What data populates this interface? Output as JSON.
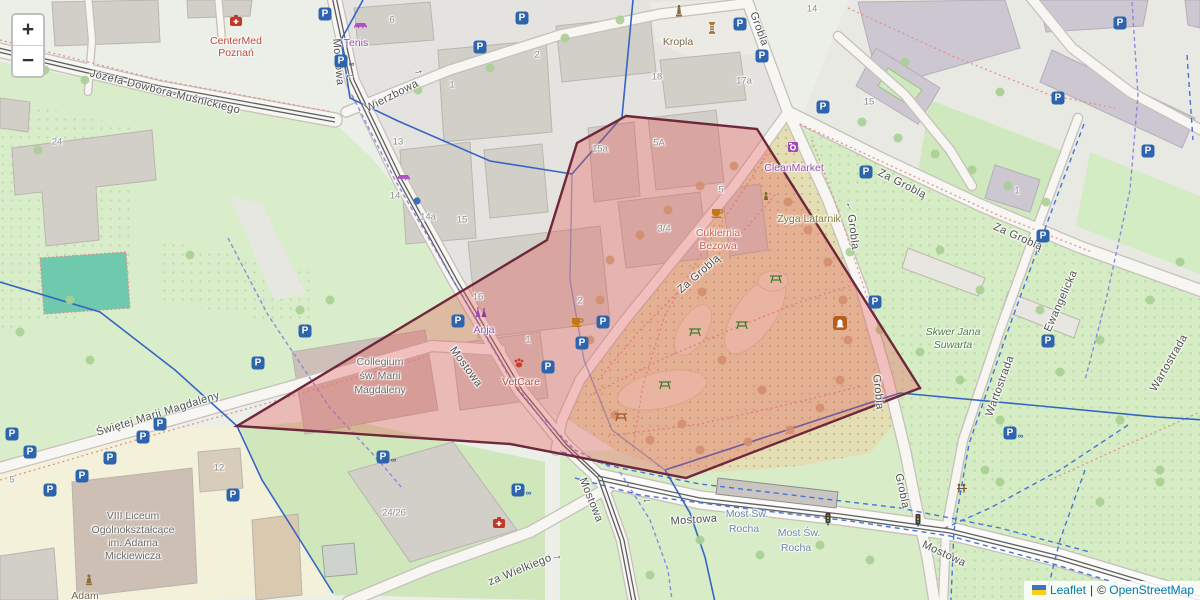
{
  "controls": {
    "zoom_in": "+",
    "zoom_out": "−"
  },
  "attribution": {
    "leaflet": "Leaflet",
    "separator": "|",
    "copyright_symbol": "©",
    "osm": "OpenStreetMap"
  },
  "colors": {
    "selection_fill": "rgba(232,82,82,0.33)",
    "selection_stroke": "#6e283c",
    "parking_blue": "#2d64ad",
    "leaflet_link": "#0078a8"
  },
  "selection": {
    "points": "626,116 757,129 920,388 686,478 510,444 237,426 497,270 547,240 577,143"
  },
  "map": {
    "labels": [
      {
        "t": "Józefa Dowbora-Muśnickiego",
        "x": 165,
        "y": 92,
        "r": 14,
        "c": "st"
      },
      {
        "t": "Mostowa",
        "x": 338,
        "y": 62,
        "r": 85,
        "c": "st"
      },
      {
        "t": "Mostowa",
        "x": 466,
        "y": 367,
        "r": 54,
        "c": "st"
      },
      {
        "t": "Mostowa",
        "x": 591,
        "y": 500,
        "r": 68,
        "c": "st"
      },
      {
        "t": "Mostowa",
        "x": 694,
        "y": 520,
        "r": -4,
        "c": "st"
      },
      {
        "t": "Mostowa",
        "x": 944,
        "y": 554,
        "r": 25,
        "c": "st"
      },
      {
        "t": "Wierzbowa",
        "x": 392,
        "y": 96,
        "r": -27,
        "c": "st"
      },
      {
        "t": "Grobla",
        "x": 759,
        "y": 29,
        "r": 70,
        "c": "st"
      },
      {
        "t": "Grobla",
        "x": 853,
        "y": 232,
        "r": 83,
        "c": "st"
      },
      {
        "t": "Grobla",
        "x": 878,
        "y": 392,
        "r": 84,
        "c": "st"
      },
      {
        "t": "Grobla",
        "x": 902,
        "y": 491,
        "r": 78,
        "c": "st"
      },
      {
        "t": "Za Groblą",
        "x": 699,
        "y": 274,
        "r": -41,
        "c": "st"
      },
      {
        "t": "Za Groblą",
        "x": 902,
        "y": 184,
        "r": 27,
        "c": "st"
      },
      {
        "t": "Za Groblą",
        "x": 1018,
        "y": 237,
        "r": 24,
        "c": "st"
      },
      {
        "t": "Ewangelicka",
        "x": 1061,
        "y": 301,
        "r": -66,
        "c": "st"
      },
      {
        "t": "Wartostrada",
        "x": 1000,
        "y": 386,
        "r": -70,
        "c": "st"
      },
      {
        "t": "Wartostrada",
        "x": 1169,
        "y": 363,
        "r": -60,
        "c": "st"
      },
      {
        "t": "Świętej Marii Magdaleny",
        "x": 158,
        "y": 414,
        "r": -17,
        "c": "st"
      },
      {
        "t": "za Wielkiego",
        "x": 520,
        "y": 570,
        "r": -22,
        "c": "st"
      },
      {
        "t": "Most Św.",
        "x": 747,
        "y": 514,
        "r": 0,
        "c": "bridge"
      },
      {
        "t": "Rocha",
        "x": 744,
        "y": 529,
        "r": 0,
        "c": "bridge"
      },
      {
        "t": "Most Św.",
        "x": 799,
        "y": 533,
        "r": 0,
        "c": "bridge"
      },
      {
        "t": "Rocha",
        "x": 796,
        "y": 548,
        "r": 0,
        "c": "bridge"
      },
      {
        "t": "CenterMed",
        "x": 236,
        "y": 41,
        "r": 0,
        "c": "poi-red"
      },
      {
        "t": "Poznań",
        "x": 236,
        "y": 53,
        "r": 0,
        "c": "poi-red"
      },
      {
        "t": "Kropla",
        "x": 678,
        "y": 42,
        "r": 0,
        "c": "poi-brown"
      },
      {
        "t": "CleanMarket",
        "x": 794,
        "y": 168,
        "r": 0,
        "c": "poi-purple"
      },
      {
        "t": "Cukiernia",
        "x": 718,
        "y": 233,
        "r": 0,
        "c": "poi-salmon"
      },
      {
        "t": "Bezowa",
        "x": 718,
        "y": 246,
        "r": 0,
        "c": "poi-salmon"
      },
      {
        "t": "Zyga Latarnik",
        "x": 809,
        "y": 219,
        "r": 0,
        "c": "poi-olive"
      },
      {
        "t": "Skwer Jana",
        "x": 953,
        "y": 332,
        "r": 0,
        "c": "poi-green"
      },
      {
        "t": "Suwarta",
        "x": 953,
        "y": 345,
        "r": 0,
        "c": "poi-green"
      },
      {
        "t": "Collegium",
        "x": 380,
        "y": 362,
        "r": 0,
        "c": "poi-gray"
      },
      {
        "t": "św. Marii",
        "x": 380,
        "y": 376,
        "r": 0,
        "c": "poi-gray"
      },
      {
        "t": "Magdaleny",
        "x": 380,
        "y": 390,
        "r": 0,
        "c": "poi-gray"
      },
      {
        "t": "VIII Liceum",
        "x": 133,
        "y": 516,
        "r": 0,
        "c": "poi-gray"
      },
      {
        "t": "Ogólnokształcące",
        "x": 133,
        "y": 530,
        "r": 0,
        "c": "poi-gray"
      },
      {
        "t": "im. Adama",
        "x": 133,
        "y": 543,
        "r": 0,
        "c": "poi-gray"
      },
      {
        "t": "Mickiewicza",
        "x": 133,
        "y": 556,
        "r": 0,
        "c": "poi-gray"
      },
      {
        "t": "VetCare",
        "x": 521,
        "y": 382,
        "r": 0,
        "c": "poi-red"
      },
      {
        "t": "Anja",
        "x": 484,
        "y": 330,
        "r": 0,
        "c": "poi-purple"
      },
      {
        "t": "Tenis",
        "x": 356,
        "y": 43,
        "r": 0,
        "c": "poi-purple"
      },
      {
        "t": "Adam",
        "x": 85,
        "y": 596,
        "r": 0,
        "c": "poi-brown"
      },
      {
        "t": "24",
        "x": 57,
        "y": 142,
        "r": 0,
        "c": "hn"
      },
      {
        "t": "6",
        "x": 392,
        "y": 20,
        "r": 0,
        "c": "hn"
      },
      {
        "t": "2",
        "x": 537,
        "y": 55,
        "r": 0,
        "c": "hn"
      },
      {
        "t": "18",
        "x": 657,
        "y": 77,
        "r": 0,
        "c": "hn"
      },
      {
        "t": "17a",
        "x": 744,
        "y": 81,
        "r": 0,
        "c": "hn"
      },
      {
        "t": "14",
        "x": 812,
        "y": 9,
        "r": 0,
        "c": "hn"
      },
      {
        "t": "15",
        "x": 869,
        "y": 102,
        "r": 0,
        "c": "hn"
      },
      {
        "t": "1",
        "x": 452,
        "y": 85,
        "r": 0,
        "c": "hn"
      },
      {
        "t": "13",
        "x": 398,
        "y": 142,
        "r": 0,
        "c": "hn"
      },
      {
        "t": "14",
        "x": 395,
        "y": 196,
        "r": 0,
        "c": "hn"
      },
      {
        "t": "14a",
        "x": 428,
        "y": 217,
        "r": 0,
        "c": "hn"
      },
      {
        "t": "15",
        "x": 462,
        "y": 220,
        "r": 0,
        "c": "hn"
      },
      {
        "t": "15a",
        "x": 600,
        "y": 149,
        "r": 0,
        "c": "hn"
      },
      {
        "t": "5A",
        "x": 659,
        "y": 143,
        "r": 0,
        "c": "hn"
      },
      {
        "t": "5",
        "x": 721,
        "y": 190,
        "r": 0,
        "c": "hn"
      },
      {
        "t": "3/4",
        "x": 664,
        "y": 229,
        "r": 0,
        "c": "hn"
      },
      {
        "t": "16",
        "x": 478,
        "y": 297,
        "r": 0,
        "c": "hn"
      },
      {
        "t": "2",
        "x": 580,
        "y": 301,
        "r": 0,
        "c": "hn"
      },
      {
        "t": "1",
        "x": 528,
        "y": 340,
        "r": 0,
        "c": "hn"
      },
      {
        "t": "12",
        "x": 219,
        "y": 468,
        "r": 0,
        "c": "hn"
      },
      {
        "t": "24/26",
        "x": 394,
        "y": 513,
        "r": 0,
        "c": "hn"
      },
      {
        "t": "1",
        "x": 1017,
        "y": 191,
        "r": 0,
        "c": "hn"
      },
      {
        "t": "5",
        "x": 12,
        "y": 480,
        "r": 0,
        "c": "hn"
      },
      {
        "t": "→",
        "x": 350,
        "y": 77,
        "r": 175,
        "c": "arrow"
      },
      {
        "t": "→",
        "x": 418,
        "y": 71,
        "r": -15,
        "c": "arrow"
      },
      {
        "t": "→",
        "x": 848,
        "y": 207,
        "r": -115,
        "c": "arrow"
      },
      {
        "t": "→",
        "x": 647,
        "y": 502,
        "r": 178,
        "c": "arrow"
      },
      {
        "t": "→",
        "x": 557,
        "y": 556,
        "r": -5,
        "c": "arrow"
      }
    ],
    "parkings": [
      [
        325,
        14,
        0
      ],
      [
        341,
        61,
        1
      ],
      [
        522,
        18,
        0
      ],
      [
        480,
        47,
        0
      ],
      [
        740,
        24,
        0
      ],
      [
        762,
        56,
        0
      ],
      [
        1120,
        23,
        0
      ],
      [
        1058,
        98,
        0
      ],
      [
        823,
        107,
        0
      ],
      [
        866,
        172,
        0
      ],
      [
        1043,
        236,
        0
      ],
      [
        1148,
        151,
        0
      ],
      [
        12,
        434,
        0
      ],
      [
        30,
        452,
        0
      ],
      [
        50,
        490,
        0
      ],
      [
        82,
        476,
        0
      ],
      [
        110,
        458,
        0
      ],
      [
        143,
        437,
        0
      ],
      [
        160,
        424,
        0
      ],
      [
        258,
        363,
        0
      ],
      [
        305,
        331,
        0
      ],
      [
        458,
        321,
        0
      ],
      [
        603,
        322,
        0
      ],
      [
        582,
        343,
        0
      ],
      [
        548,
        367,
        0
      ],
      [
        875,
        302,
        0
      ],
      [
        233,
        495,
        0
      ],
      [
        383,
        457,
        1
      ],
      [
        518,
        490,
        1
      ],
      [
        1010,
        433,
        1
      ],
      [
        1048,
        341,
        0
      ]
    ],
    "icons": [
      {
        "t": "firstaid",
        "x": 236,
        "y": 21
      },
      {
        "t": "firstaid",
        "x": 499,
        "y": 523
      },
      {
        "t": "cafe",
        "x": 717,
        "y": 212
      },
      {
        "t": "cafe",
        "x": 577,
        "y": 321
      },
      {
        "t": "vet",
        "x": 519,
        "y": 363
      },
      {
        "t": "clothes",
        "x": 481,
        "y": 313
      },
      {
        "t": "laundry",
        "x": 793,
        "y": 147
      },
      {
        "t": "awning",
        "x": 360,
        "y": 28
      },
      {
        "t": "awning",
        "x": 403,
        "y": 180
      },
      {
        "t": "obelisk",
        "x": 679,
        "y": 11
      },
      {
        "t": "column",
        "x": 712,
        "y": 28
      },
      {
        "t": "statue",
        "x": 89,
        "y": 580
      },
      {
        "t": "zyga",
        "x": 766,
        "y": 197
      },
      {
        "t": "plaque",
        "x": 840,
        "y": 323
      },
      {
        "t": "picnicg",
        "x": 665,
        "y": 385
      },
      {
        "t": "picnicg",
        "x": 695,
        "y": 332
      },
      {
        "t": "picnicg",
        "x": 742,
        "y": 325
      },
      {
        "t": "picnicg",
        "x": 776,
        "y": 279
      },
      {
        "t": "picnicb",
        "x": 621,
        "y": 417
      },
      {
        "t": "fitness",
        "x": 962,
        "y": 489
      },
      {
        "t": "traffic",
        "x": 828,
        "y": 519
      },
      {
        "t": "traffic",
        "x": 918,
        "y": 520
      },
      {
        "t": "bluedot",
        "x": 417,
        "y": 201
      }
    ]
  }
}
